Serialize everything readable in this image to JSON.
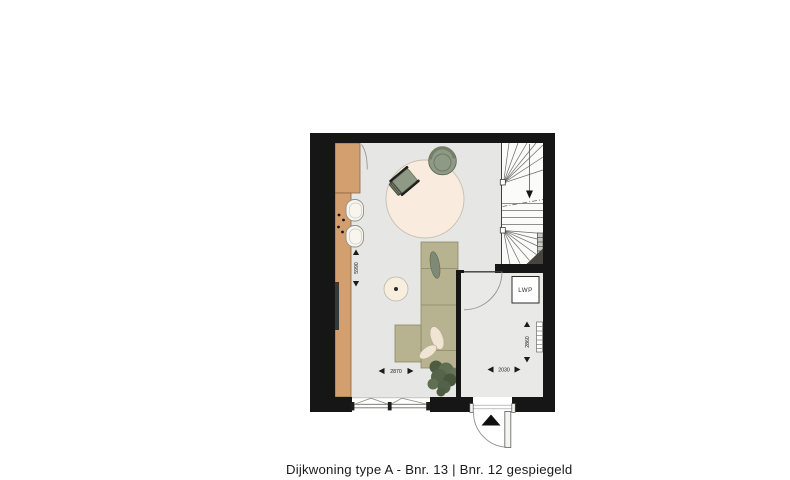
{
  "caption": "Dijkwoning type A - Bnr. 13 | Bnr. 12 gespiegeld",
  "plan": {
    "labels": {
      "heat_pump": "LWP"
    },
    "dimensions": {
      "living_depth_mm": "5990",
      "living_width_mm": "2870",
      "hall_width_mm": "2030",
      "hall_depth_mm": "2860"
    },
    "colors": {
      "wall": "#161616",
      "floor_living": "#e6e6e4",
      "floor_hall": "#e9e9e7",
      "floor_stairs": "#fbfbfa",
      "kitchen_counter": "#d49f6e",
      "rug": "#f9ecdf",
      "seating_sage": "#8e9a86",
      "sofa_khaki": "#b7b390",
      "cushion_cream": "#f0e4d2",
      "plant_green": "#5f6f51"
    },
    "icons": {
      "entry_marker": "entry-arrow-icon",
      "stairs_direction": "stairs-up-arrow-icon"
    }
  }
}
